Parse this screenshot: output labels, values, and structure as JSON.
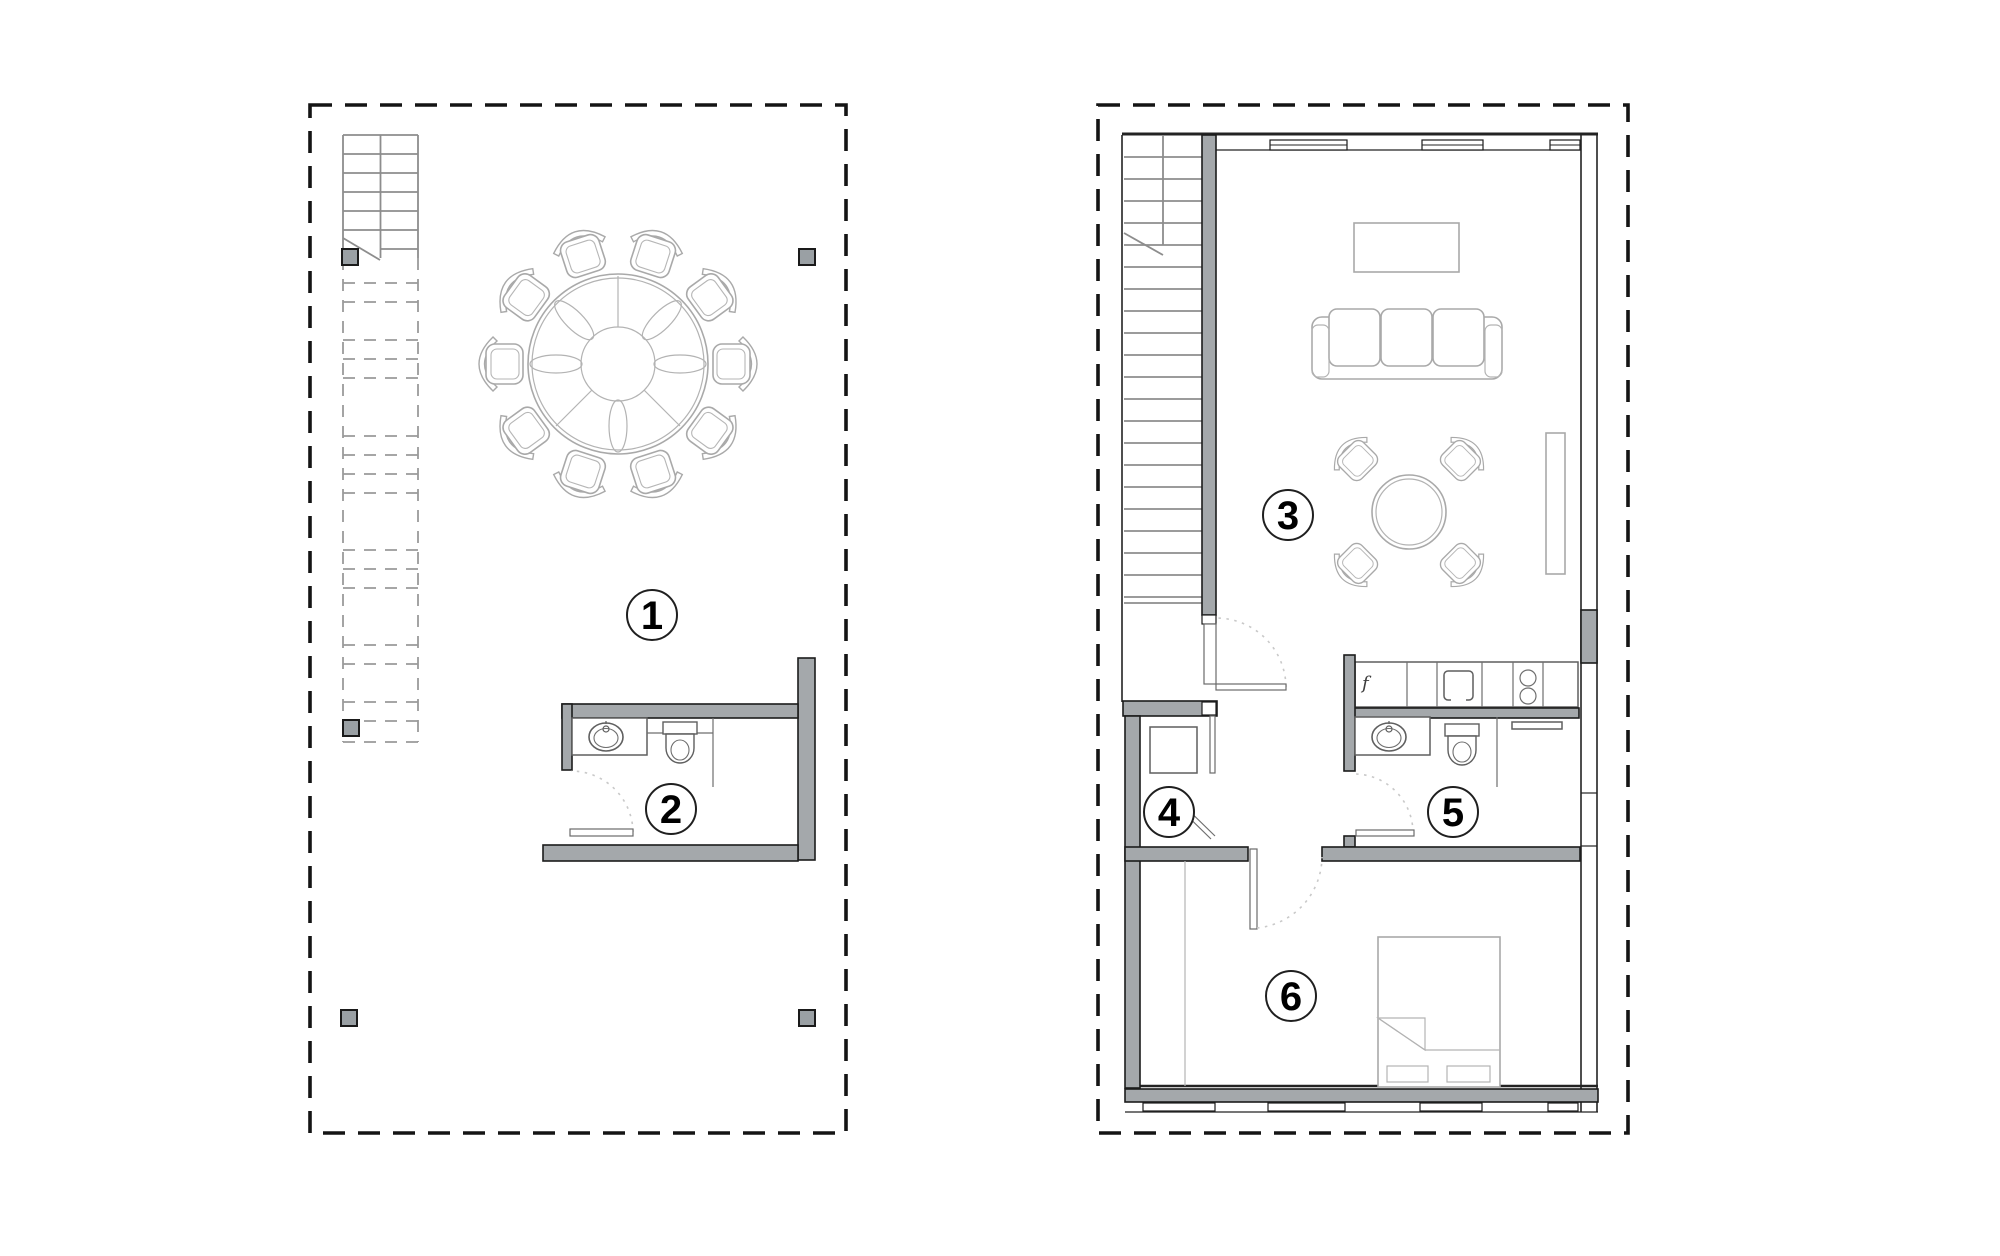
{
  "drawing": {
    "type": "architectural-floor-plan",
    "plan_count": 2
  },
  "colors": {
    "background": "#ffffff",
    "wall_fill": "#a4a8ab",
    "wall_outline": "#1c1c1c",
    "boundary_dash": "#141414",
    "stair_line": "#8d8d8d",
    "furniture_line": "#a9a9a9",
    "fixture_line": "#5f5f5f",
    "door_swing_dots": "#c9c9c9",
    "label_text": "#000000"
  },
  "plan_left": {
    "room_labels": [
      {
        "number": "1"
      },
      {
        "number": "2"
      }
    ]
  },
  "plan_right": {
    "room_labels": [
      {
        "number": "3"
      },
      {
        "number": "4"
      },
      {
        "number": "5"
      },
      {
        "number": "6"
      }
    ],
    "kitchen_label": "f"
  }
}
